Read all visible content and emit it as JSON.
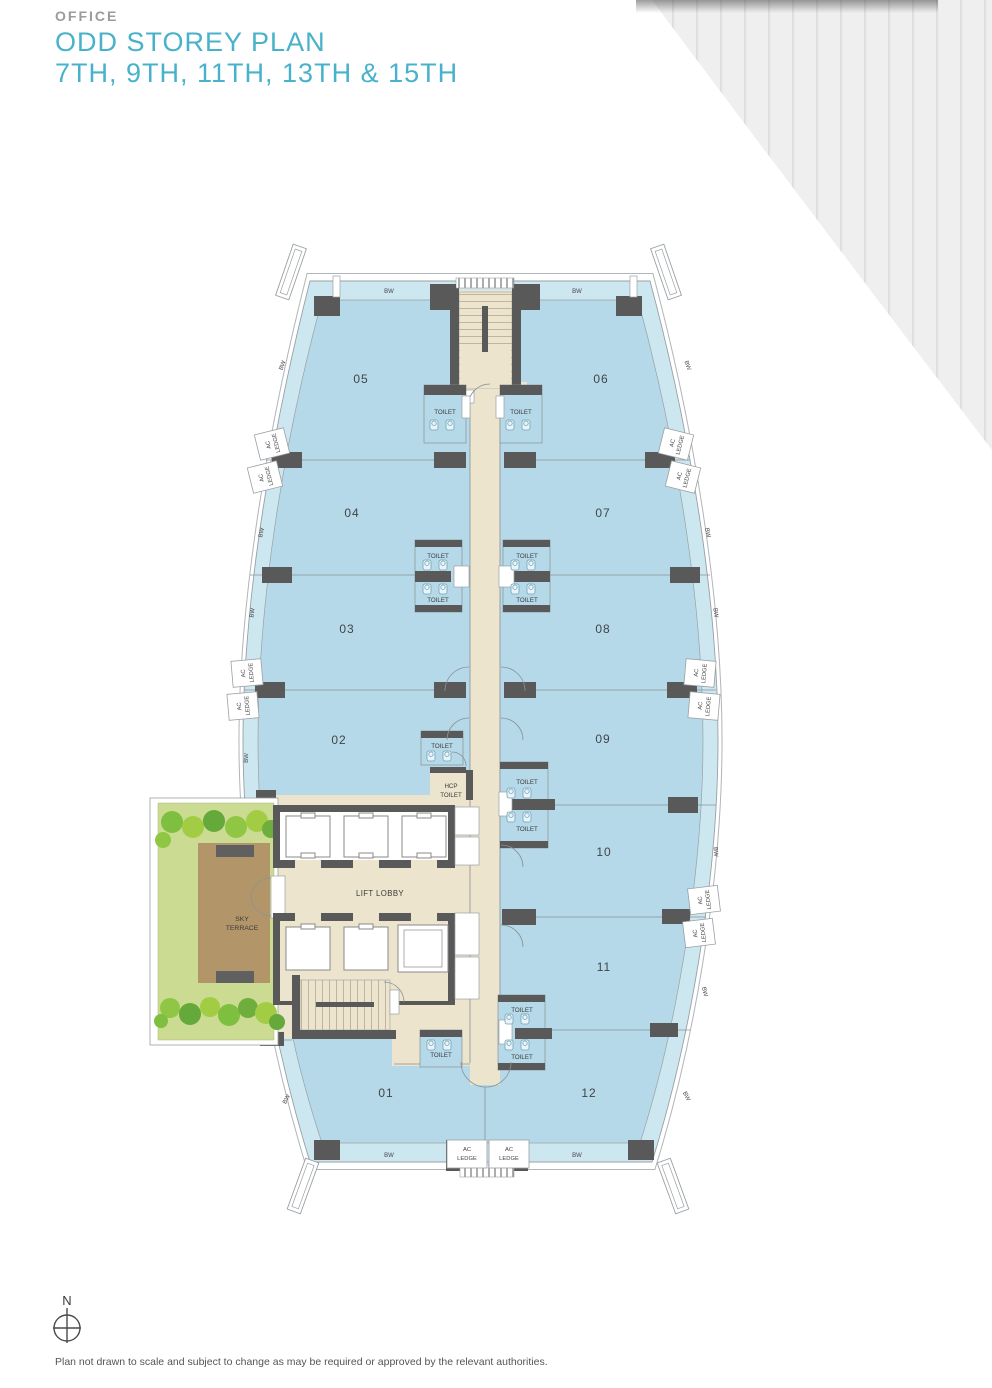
{
  "header": {
    "category": "OFFICE",
    "title": "ODD STOREY PLAN",
    "subtitle": "7TH, 9TH, 11TH, 13TH & 15TH"
  },
  "plan": {
    "units": {
      "u01": "01",
      "u02": "02",
      "u03": "03",
      "u04": "04",
      "u05": "05",
      "u06": "06",
      "u07": "07",
      "u08": "08",
      "u09": "09",
      "u10": "10",
      "u11": "11",
      "u12": "12"
    },
    "labels": {
      "toilet": "TOILET",
      "hcp_line1": "HCP",
      "hcp_line2": "TOILET",
      "lift_lobby": "LIFT LOBBY",
      "sky_line1": "SKY",
      "sky_line2": "TERRACE",
      "ac": "AC",
      "ledge": "LEDGE",
      "bw": "BW"
    },
    "colors": {
      "band_blue": "#cde7f1",
      "unit_blue": "#b5d9e8",
      "core_beige": "#ece4cd",
      "wall_grey": "#595959",
      "lawn_green": "#cbdb92",
      "deck_brown": "#b2966a",
      "accent_teal": "#47b2ca"
    }
  },
  "compass": {
    "north": "N"
  },
  "footer": {
    "disclaimer": "Plan not drawn to scale and subject to change as may be required or approved by the relevant authorities."
  }
}
